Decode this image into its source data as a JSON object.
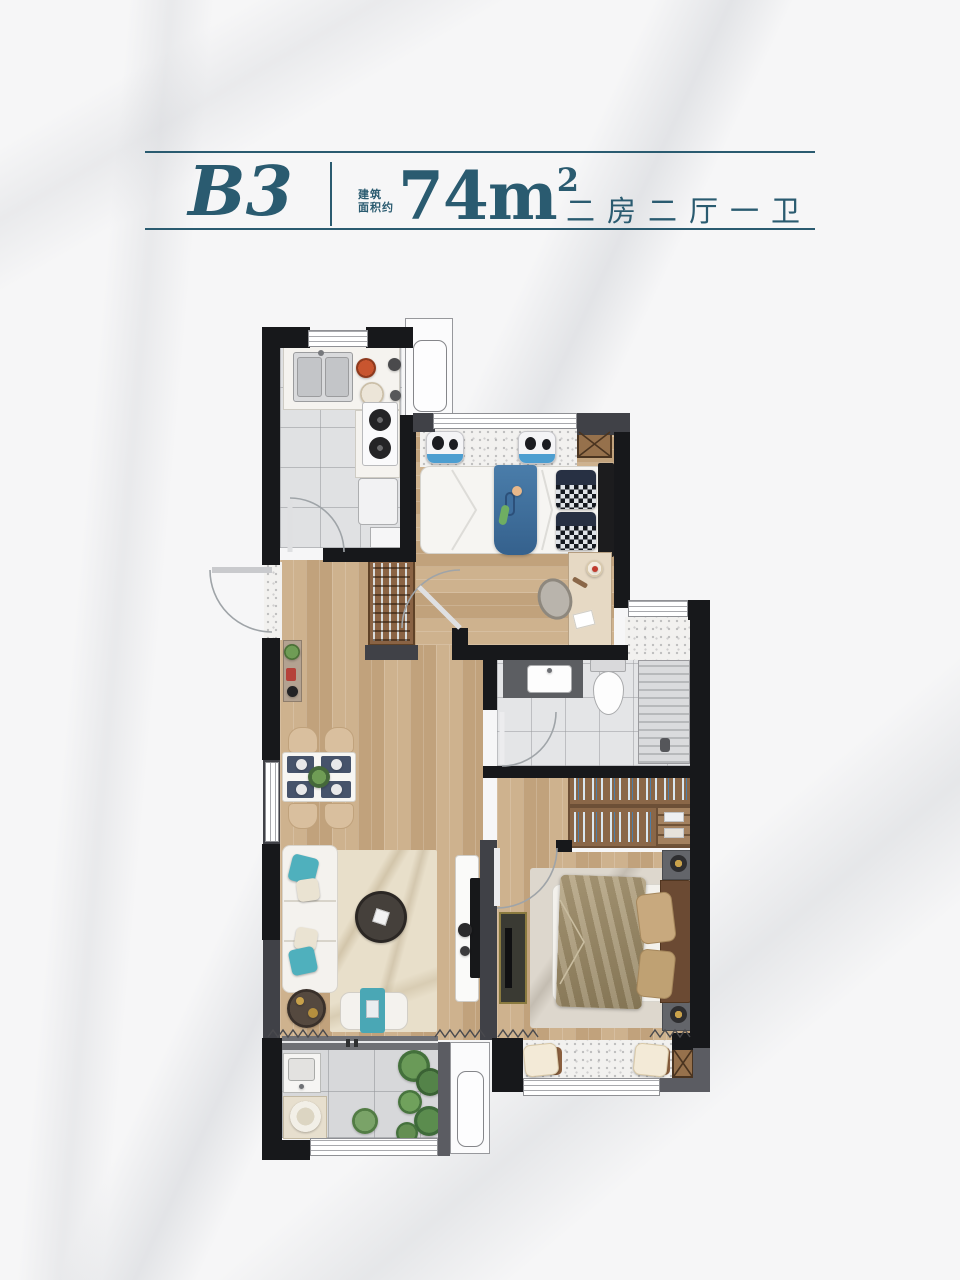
{
  "header": {
    "unit": "B3",
    "area_label_line1": "建筑",
    "area_label_line2": "面积约",
    "area_value": "74",
    "area_unit": "m",
    "area_exponent": "2",
    "layout_text": "二房二厅一卫",
    "accent_color": "#2a5b70"
  },
  "palette": {
    "accent": "#2a5b70",
    "wall_dark": "#17181b",
    "wall_gray": "#404147",
    "wood_floor": "#c8ab86",
    "kitchen_tile": "#e0e1e3",
    "terrazzo": "#f2f1ef",
    "teal_accent": "#4fb0bd",
    "cabinet_wood": "#8a6748",
    "child_blanket_blue": "#3f6f9e",
    "master_blanket_khaki": "#a59272"
  }
}
